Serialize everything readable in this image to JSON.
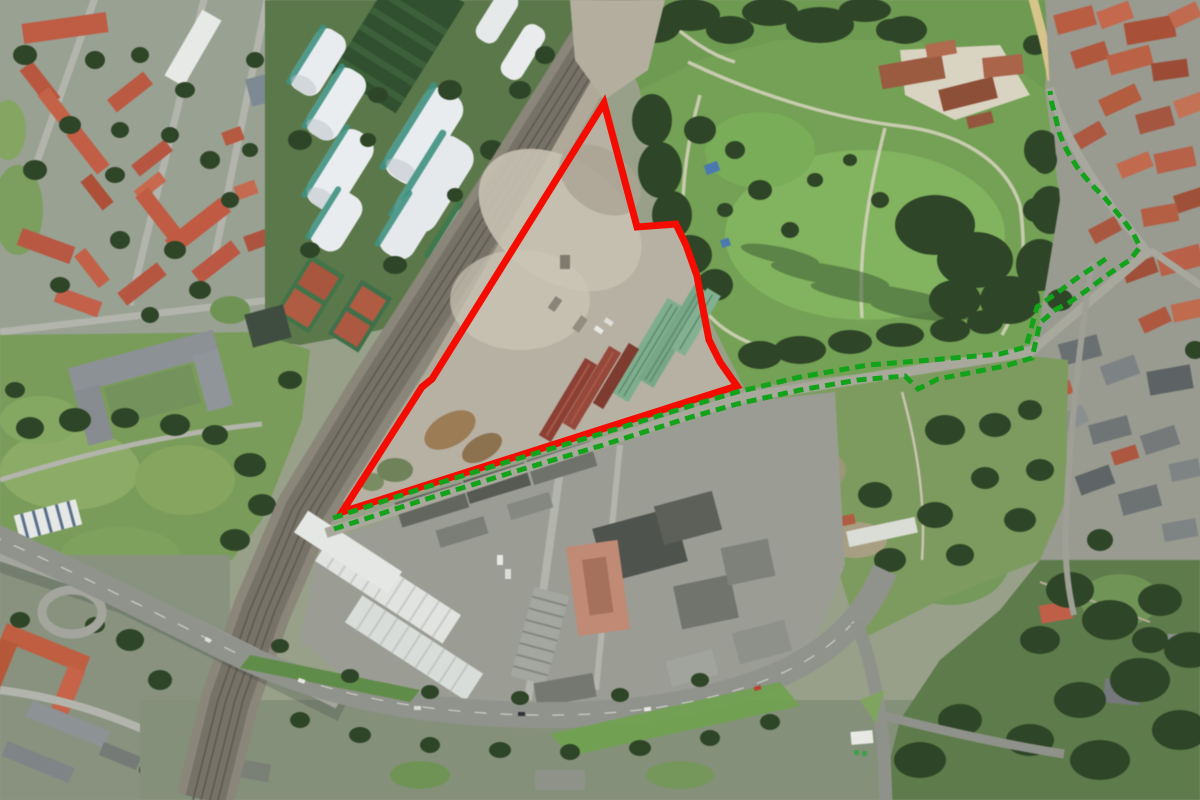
{
  "meta": {
    "view_type": "satellite-aerial",
    "width": 1200,
    "height": 800,
    "visible_text": "none"
  },
  "overlays": {
    "site_boundary": {
      "name": "site-boundary-polygon",
      "color": "#f50c00",
      "stroke_width": 7,
      "closed": true,
      "points": [
        [
          604,
          103
        ],
        [
          637,
          227
        ],
        [
          676,
          224
        ],
        [
          686,
          245
        ],
        [
          697,
          276
        ],
        [
          703,
          309
        ],
        [
          709,
          340
        ],
        [
          720,
          362
        ],
        [
          737,
          386
        ],
        [
          342,
          512
        ],
        [
          422,
          387
        ],
        [
          432,
          379
        ]
      ]
    },
    "route": {
      "color": "#12a31a",
      "stroke_width": 5,
      "dash": [
        10,
        6
      ],
      "lines": [
        {
          "name": "route-line-north",
          "points": [
            [
              333,
              518
            ],
            [
              420,
              489
            ],
            [
              510,
              461
            ],
            [
              600,
              434
            ],
            [
              690,
              406
            ],
            [
              737,
              392
            ],
            [
              800,
              377
            ],
            [
              868,
              365
            ],
            [
              930,
              360
            ],
            [
              1000,
              354
            ],
            [
              1026,
              347
            ],
            [
              1037,
              307
            ],
            [
              1057,
              293
            ],
            [
              1077,
              278
            ],
            [
              1097,
              265
            ],
            [
              1107,
              258
            ]
          ]
        },
        {
          "name": "route-line-south",
          "points": [
            [
              334,
              529
            ],
            [
              420,
              501
            ],
            [
              510,
              473
            ],
            [
              600,
              446
            ],
            [
              688,
              418
            ],
            [
              737,
              404
            ],
            [
              800,
              390
            ],
            [
              858,
              380
            ],
            [
              905,
              376
            ],
            [
              918,
              389
            ],
            [
              938,
              379
            ],
            [
              1005,
              366
            ],
            [
              1032,
              358
            ],
            [
              1040,
              323
            ],
            [
              1055,
              310
            ],
            [
              1070,
              302
            ],
            [
              1090,
              288
            ],
            [
              1110,
              273
            ],
            [
              1130,
              260
            ],
            [
              1140,
              247
            ],
            [
              1133,
              233
            ],
            [
              1124,
              221
            ],
            [
              1114,
              209
            ],
            [
              1104,
              197
            ],
            [
              1094,
              187
            ],
            [
              1085,
              177
            ],
            [
              1077,
              167
            ],
            [
              1070,
              156
            ],
            [
              1064,
              145
            ],
            [
              1059,
              132
            ],
            [
              1056,
              119
            ],
            [
              1052,
              104
            ],
            [
              1050,
              91
            ]
          ]
        }
      ]
    }
  }
}
